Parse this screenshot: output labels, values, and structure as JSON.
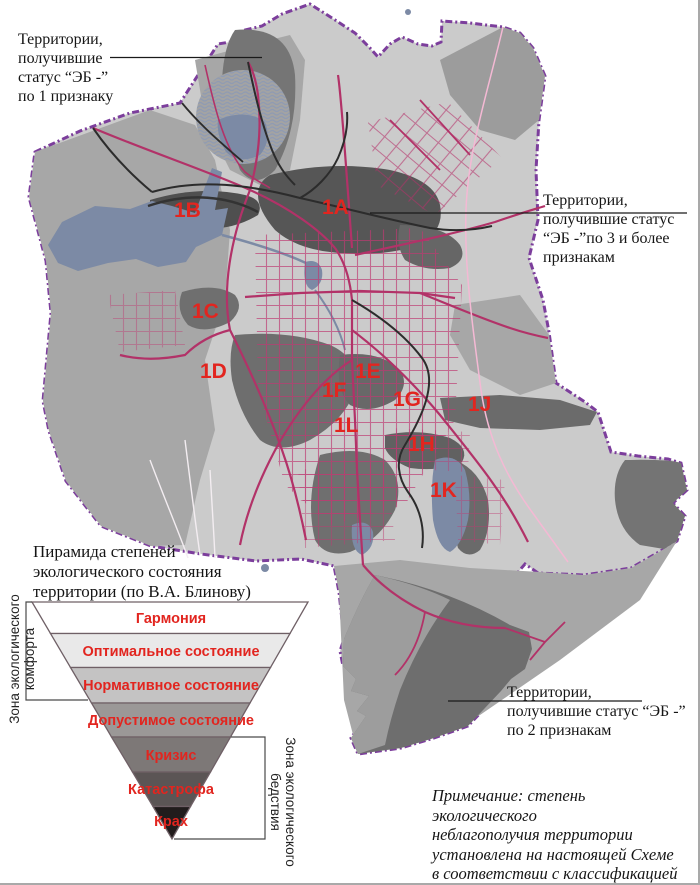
{
  "figure": {
    "callout_one_sign": {
      "lines": [
        "Территории,",
        "получившие",
        "статус “ЭБ -”",
        "по 1 признаку"
      ]
    },
    "callout_three_signs": {
      "lines": [
        "Территории,",
        "получившие статус",
        "“ЭБ -”по 3 и более",
        "признакам"
      ]
    },
    "callout_two_signs": {
      "lines": [
        "Территории,",
        "получившие статус “ЭБ -”",
        "по 2 признакам"
      ]
    },
    "note": {
      "lines": [
        "Примечание: степень экологического",
        "неблагополучия территории",
        "установлена на настоящей Схеме",
        "в соответствии с классификацией",
        "Блинова В.А."
      ]
    }
  },
  "map": {
    "labels": [
      {
        "text": "1A"
      },
      {
        "text": "1B"
      },
      {
        "text": "1C"
      },
      {
        "text": "1D"
      },
      {
        "text": "1E"
      },
      {
        "text": "1F"
      },
      {
        "text": "1G"
      },
      {
        "text": "1H"
      },
      {
        "text": "1J"
      },
      {
        "text": "1K"
      },
      {
        "text": "1L"
      }
    ],
    "colors": {
      "boundary": "#7c3e9c",
      "base_area": "#cbcbcb",
      "medium_area": "#a7a7a7",
      "dark_area": "#6e6e6e",
      "darkest_area": "#565656",
      "water": "#7c8aa5",
      "road_main": "#b23268",
      "road_pink": "#f4b9d4",
      "railway": "#2c2c2c",
      "label_red": "#e2251f"
    }
  },
  "pyramid": {
    "title_lines": [
      "Пирамида степеней",
      "экологического состояния",
      "территории (по В.А. Блинову)"
    ],
    "levels": [
      {
        "label": "Гармония",
        "color": "#ffffff"
      },
      {
        "label": "Оптимальное состояние",
        "color": "#e9e9e9"
      },
      {
        "label": "Нормативное состояние",
        "color": "#c4c3c3"
      },
      {
        "label": "Допустимое состояние",
        "color": "#9b9897"
      },
      {
        "label": "Кризис",
        "color": "#7d7877"
      },
      {
        "label": "Катастрофа",
        "color": "#5b5555"
      },
      {
        "label": "Крах",
        "color": "#211c1c"
      }
    ],
    "zone_comfort_lines": [
      "Зона экологического",
      "комфорта"
    ],
    "zone_disaster_lines": [
      "Зона экологического",
      "бедствия"
    ]
  }
}
